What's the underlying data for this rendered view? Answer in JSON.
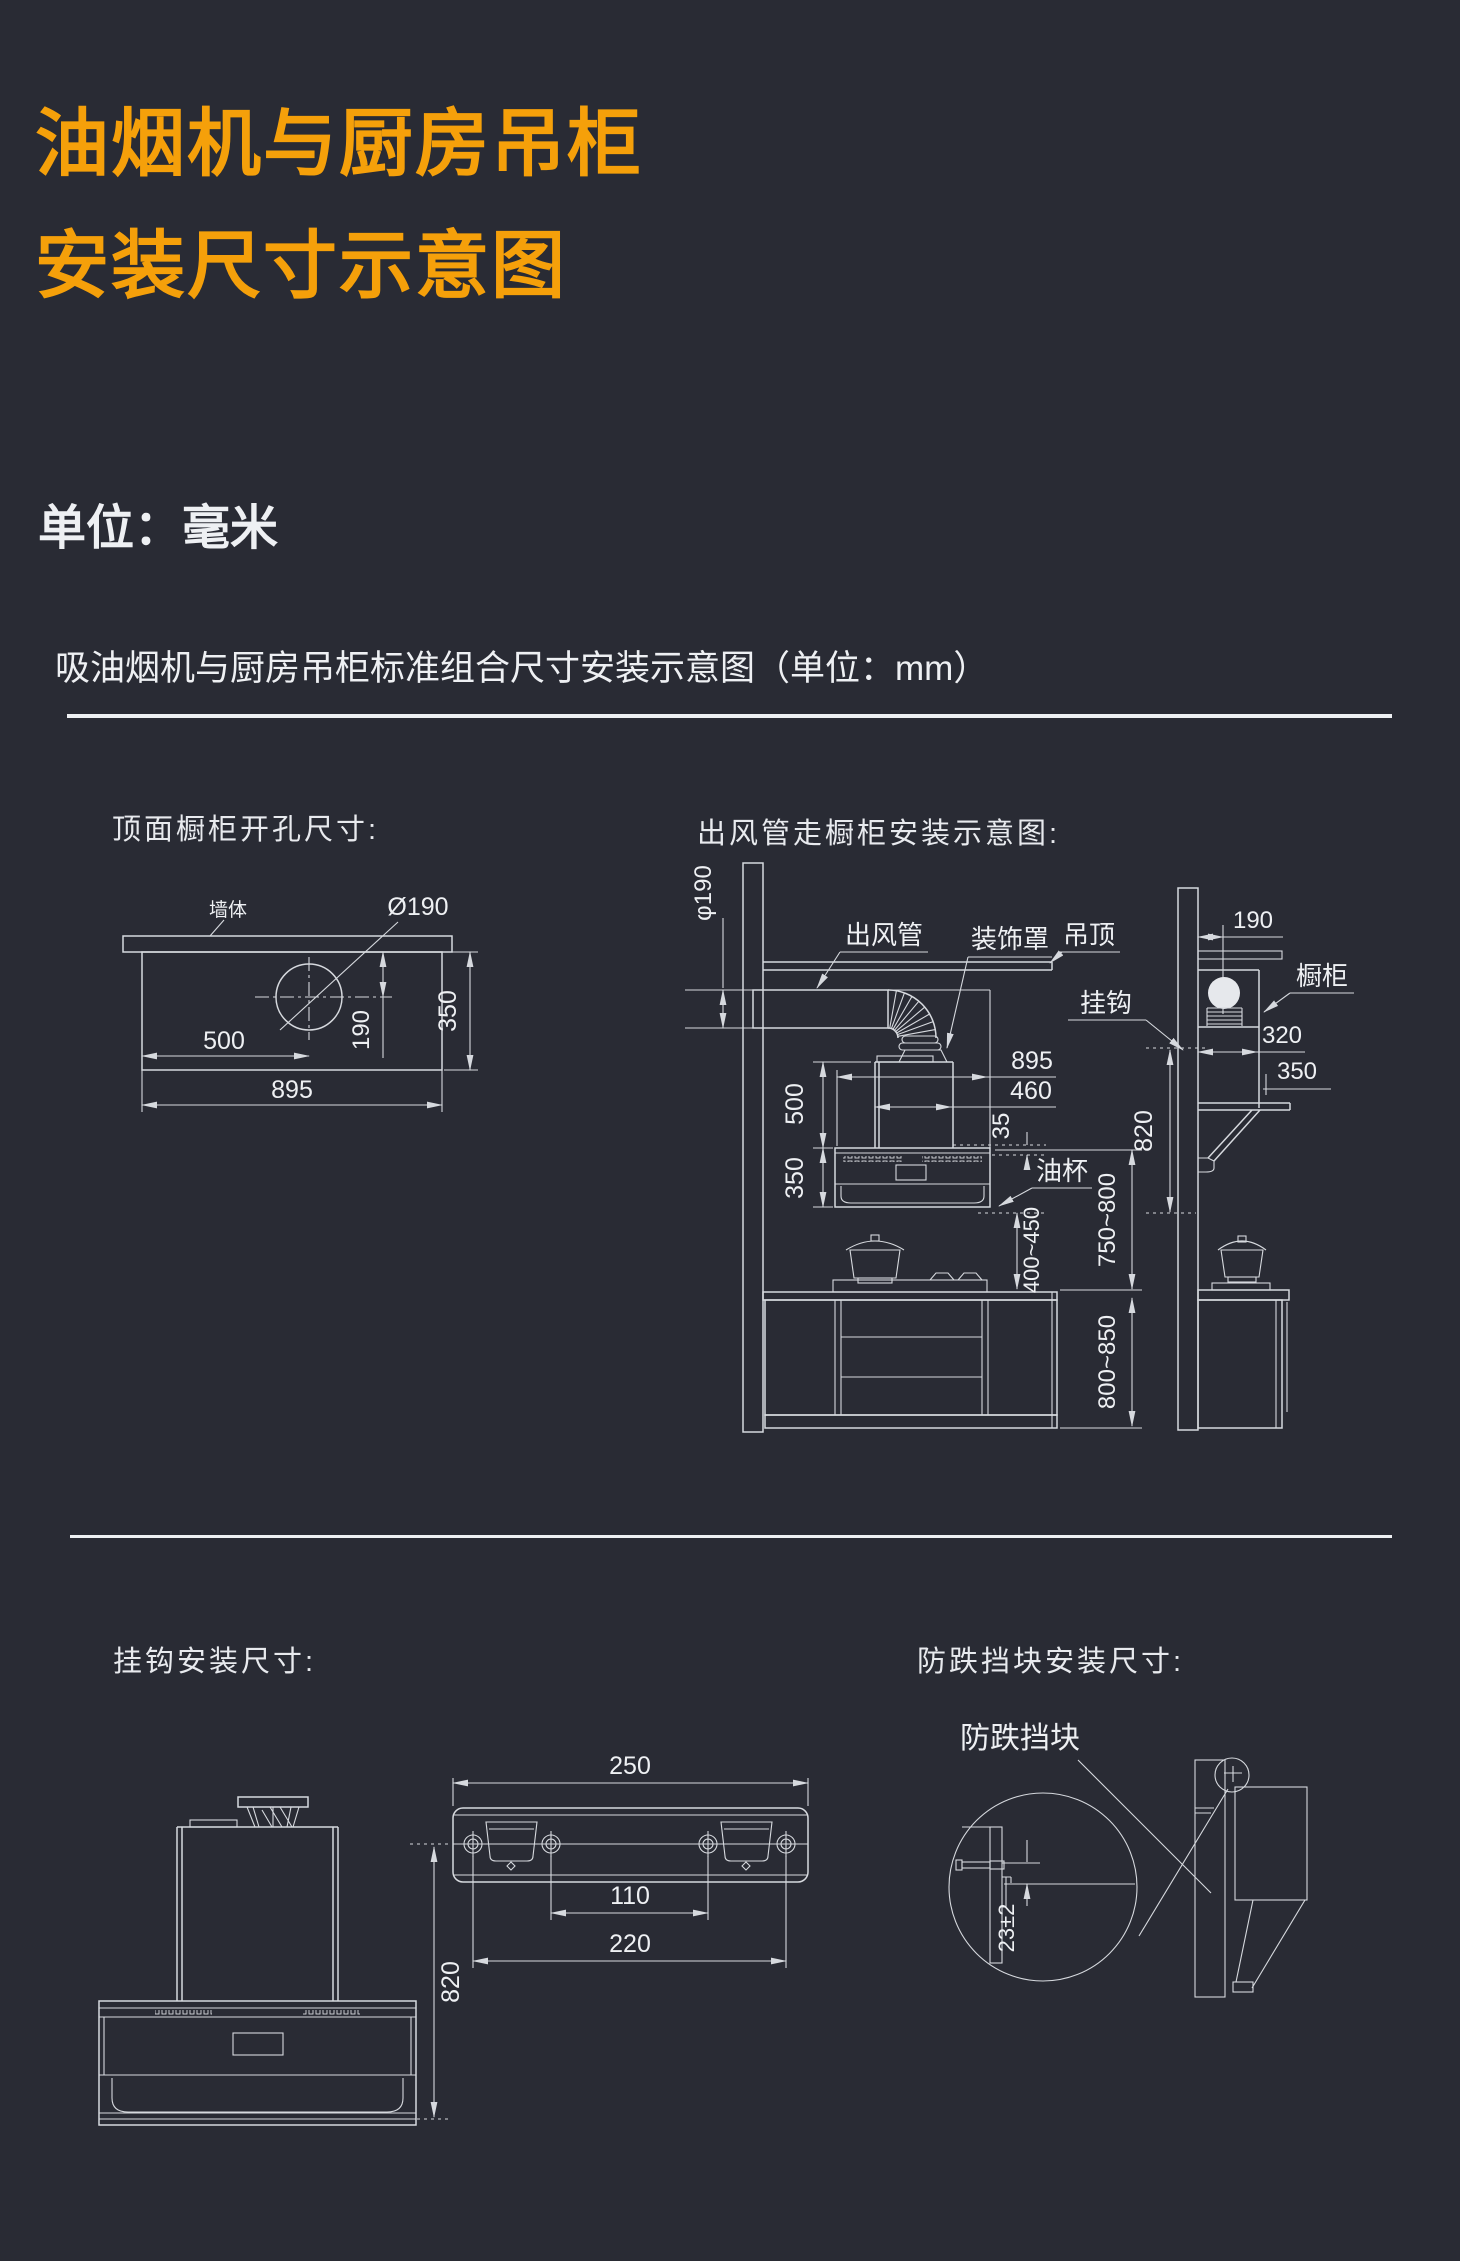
{
  "colors": {
    "background": "#292b34",
    "accent_orange": "#f5a00a",
    "line": "#d6d9de",
    "text": "#eef0f3"
  },
  "header": {
    "title_line1": "油烟机与厨房吊柜",
    "title_line2": "安装尺寸示意图",
    "unit_note": "单位：毫米",
    "subtitle": "吸油烟机与厨房吊柜标准组合尺寸安装示意图（单位：mm）"
  },
  "s1": {
    "title": "顶面橱柜开孔尺寸:",
    "wall": "墙体",
    "hole": "Ø190",
    "d500": "500",
    "d895": "895",
    "d190": "190",
    "d350": "350"
  },
  "s2": {
    "title": "出风管走橱柜安装示意图:",
    "duct": "出风管",
    "cover": "装饰罩",
    "ceiling": "吊顶",
    "hook": "挂钩",
    "cabinet": "橱柜",
    "oilcup": "油杯",
    "dia": "φ190",
    "d895": "895",
    "d460": "460",
    "d35": "35",
    "d500": "500",
    "d350": "350",
    "d400": "400~450",
    "d750": "750~800",
    "d800": "800~850",
    "d820": "820",
    "d190": "190",
    "d320": "320",
    "d350b": "350"
  },
  "s3": {
    "title": "挂钩安装尺寸:",
    "d250": "250",
    "d110": "110",
    "d220": "220",
    "d820": "820"
  },
  "s4": {
    "title": "防跌挡块安装尺寸:",
    "block": "防跌挡块",
    "d23": "23±2"
  }
}
